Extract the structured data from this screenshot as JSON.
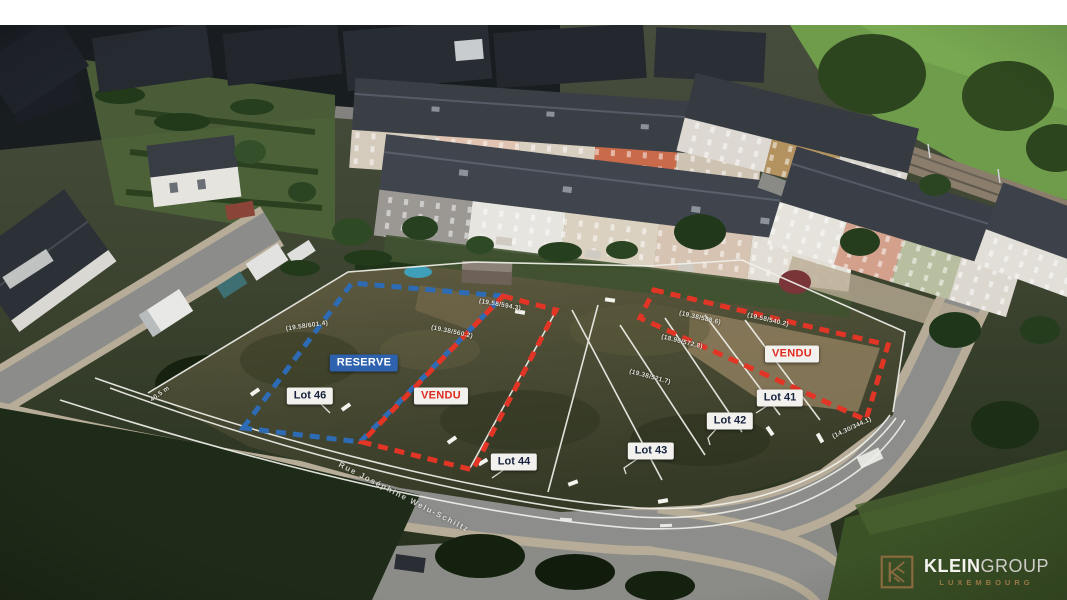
{
  "annotations": {
    "status_labels": {
      "reserve": "RESERVE",
      "vendu_left": "VENDU",
      "vendu_right": "VENDU"
    },
    "lot_labels": {
      "lot41": "Lot 41",
      "lot42": "Lot 42",
      "lot43": "Lot 43",
      "lot44": "Lot 44",
      "lot46": "Lot 46"
    },
    "survey_marks": {
      "m1": "(19.58/594.3)",
      "m2": "(19.38/560.2)",
      "m3": "(19.58/601.4)",
      "m4": "(19.38/588.6)",
      "m5": "(19.58/540.2)",
      "m6": "(18.96/572.8)",
      "m7": "(19.38/521.7)",
      "m8": "(14.30/344.1)",
      "m9": "40.5 m"
    },
    "street_label": "Rue Joséphine Welu-Schiltz",
    "colors": {
      "reserve_bg": "#2e62ae",
      "vendu_text": "#e02b20",
      "lot_text": "#17233f",
      "boundary_blue": "#2d6bb5",
      "boundary_red": "#e23525",
      "survey_line_white": "#f0f0ea"
    }
  },
  "logo": {
    "brand_bold": "KLEIN",
    "brand_light": "GROUP",
    "location": "LUXEMBOURG",
    "gold": "#8a6b3f"
  }
}
